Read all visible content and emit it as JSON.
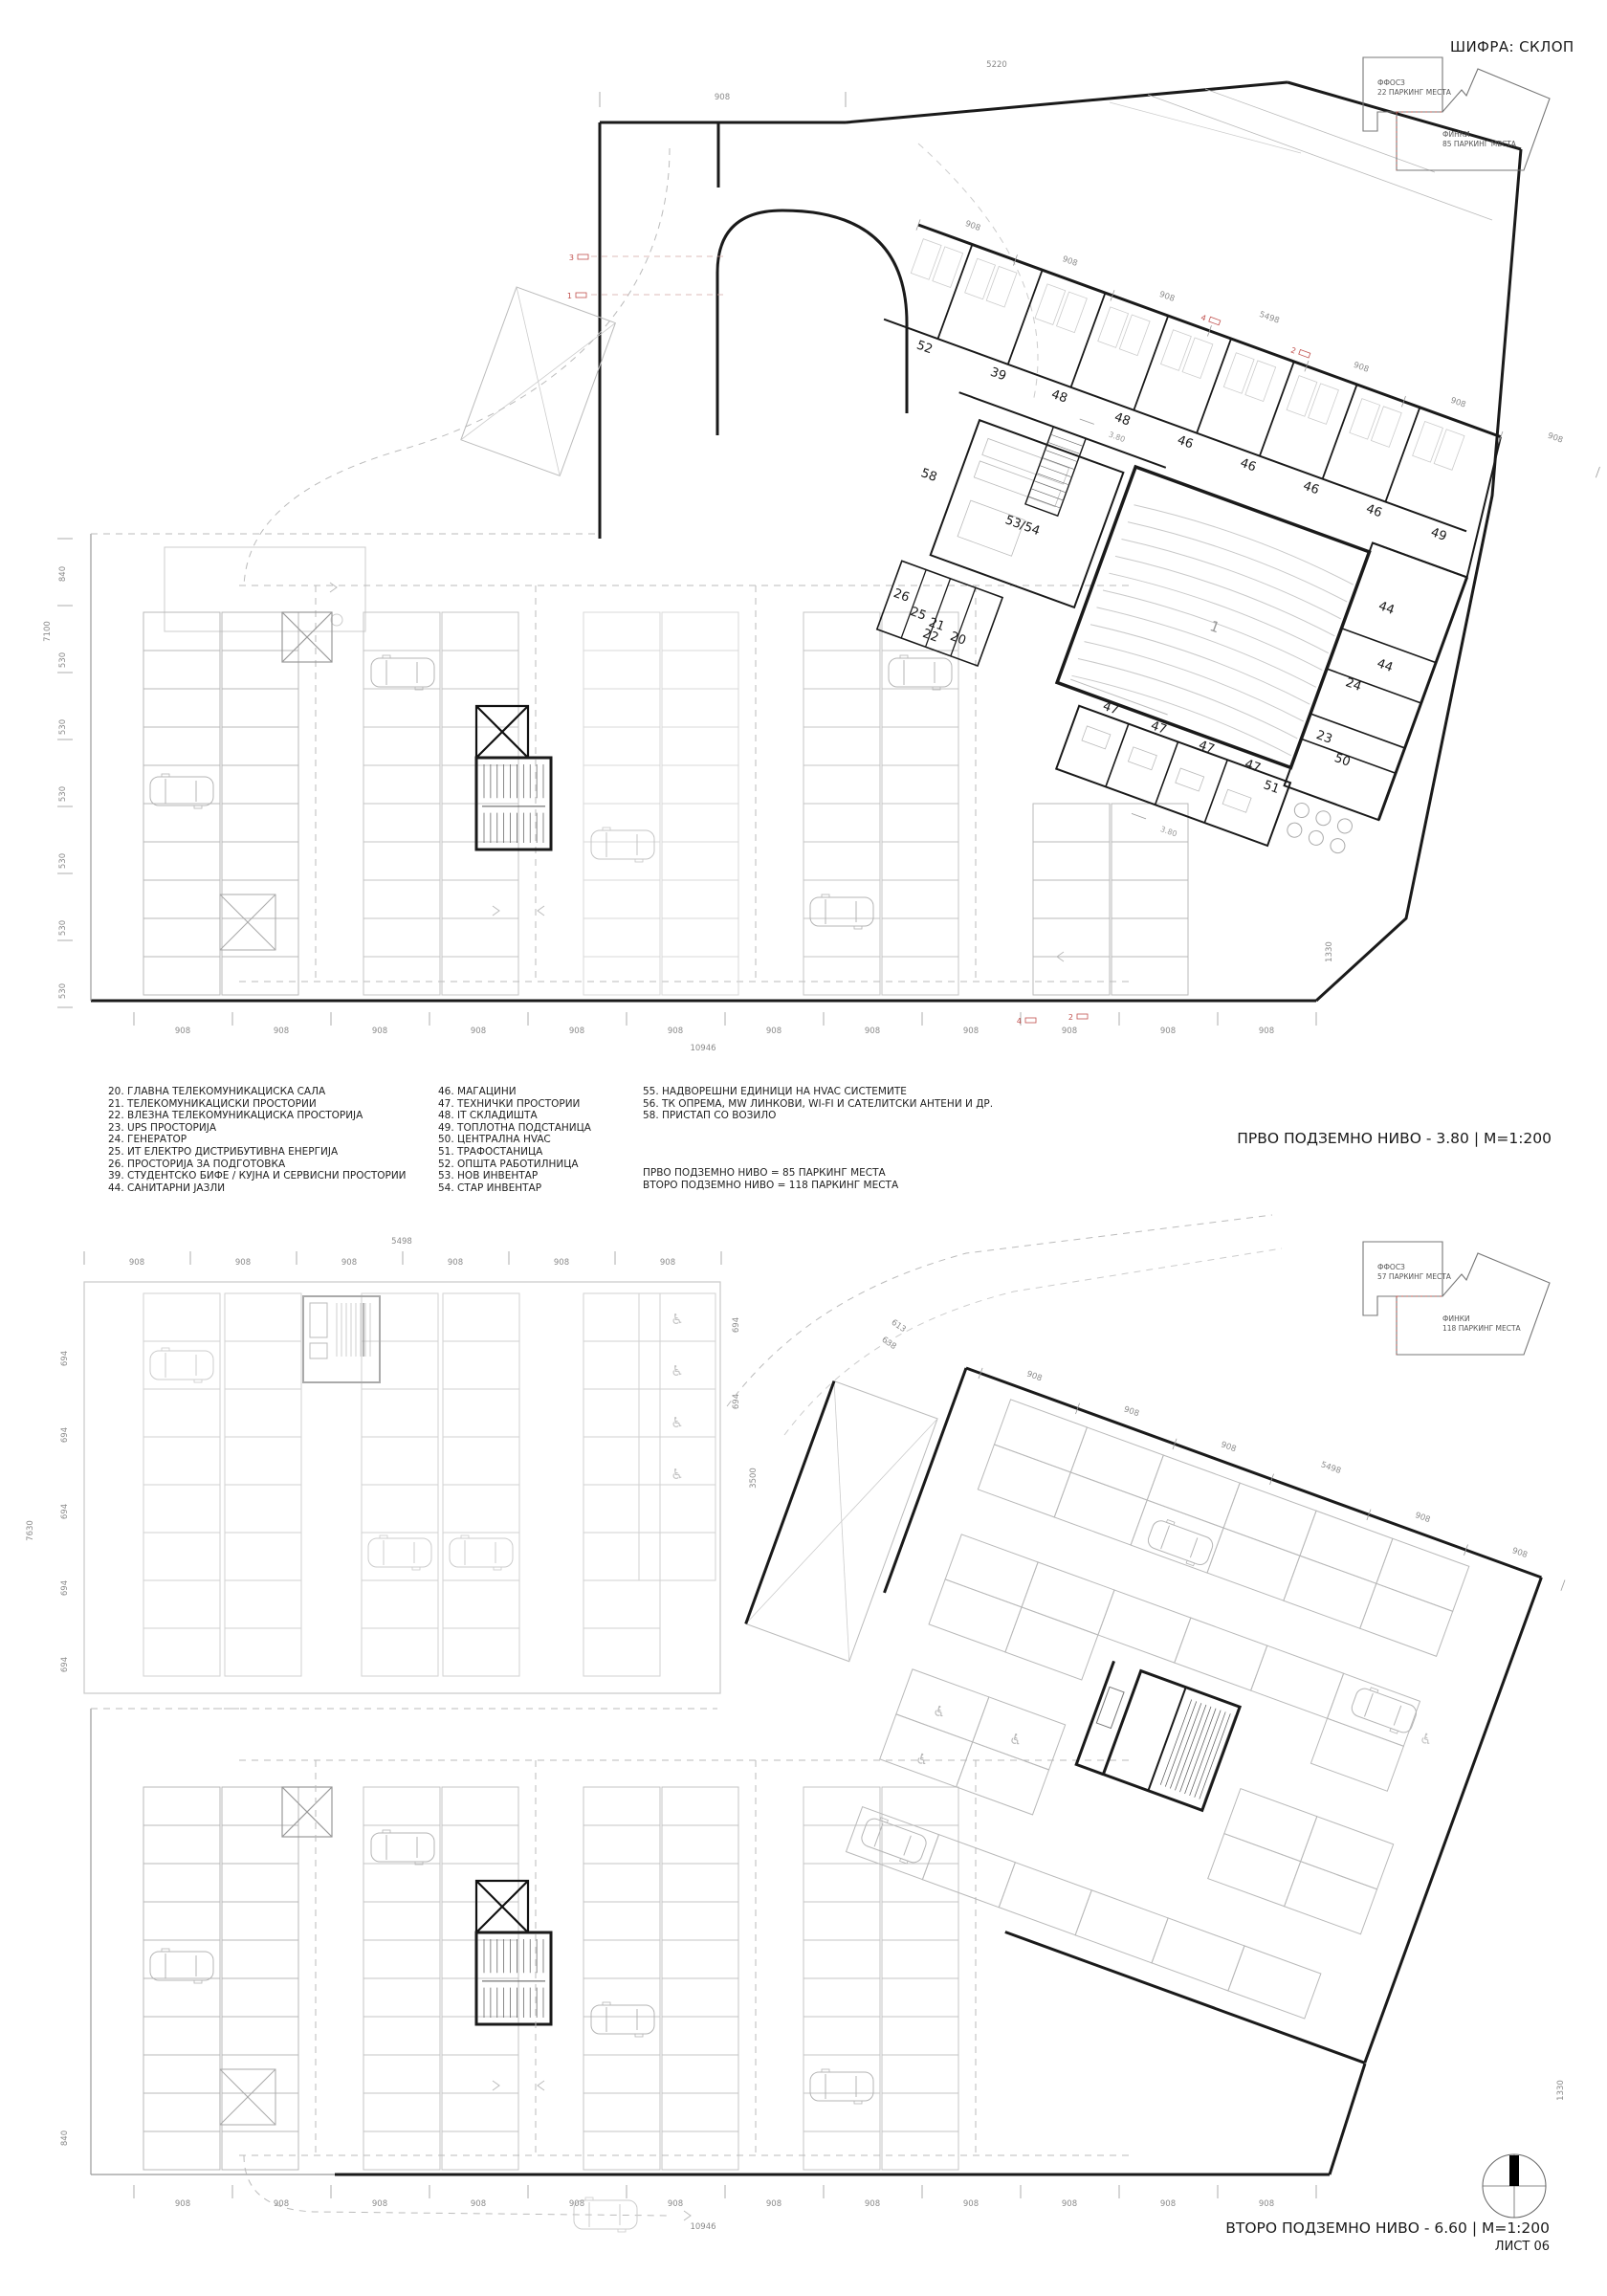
{
  "header": {
    "code": "ШИФРА: СКЛОП"
  },
  "keyplans": {
    "level1": {
      "zone_a_name": "ФФОСЗ",
      "zone_a_count": "22 ПАРКИНГ МЕСТА",
      "zone_b_name": "ФИНКИ",
      "zone_b_count": "85 ПАРКИНГ МЕСТА"
    },
    "level2": {
      "zone_a_name": "ФФОСЗ",
      "zone_a_count": "57 ПАРКИНГ МЕСТА",
      "zone_b_name": "ФИНКИ",
      "zone_b_count": "118 ПАРКИНГ МЕСТА"
    }
  },
  "legend": {
    "col1": [
      "20. ГЛАВНА ТЕЛЕКОМУНИКАЦИСКА САЛА",
      "21. ТЕЛЕКОМУНИКАЦИСКИ ПРОСТОРИИ",
      "22. ВЛЕЗНА ТЕЛЕКОМУНИКАЦИСКА ПРОСТОРИЈА",
      "23. UPS ПРОСТОРИЈА",
      "24. ГЕНЕРАТОР",
      "25. ИТ ЕЛЕКТРО ДИСТРИБУТИВНА ЕНЕРГИЈА",
      "26. ПРОСТОРИЈА ЗА ПОДГОТОВКА",
      "39. СТУДЕНТСКО БИФЕ / КУЈНА И СЕРВИСНИ ПРОСТОРИИ",
      "44. САНИТАРНИ ЈАЗЛИ"
    ],
    "col2": [
      "46. МАГАЦИНИ",
      "47. ТЕХНИЧКИ ПРОСТОРИИ",
      "48. IT СКЛАДИШТА",
      "49. ТОПЛОТНА ПОДСТАНИЦА",
      "50. ЦЕНТРАЛНА HVAC",
      "51. ТРАФОСТАНИЦА",
      "52. ОПШТА РАБОТИЛНИЦА",
      "53. НОВ ИНВЕНТАР",
      "54. СТАР ИНВЕНТАР"
    ],
    "col3": [
      "55. НАДВОРЕШНИ ЕДИНИЦИ НА HVAC СИСТЕМИТЕ",
      "56. ТК ОПРЕМА, MW ЛИНКОВИ, WI-FI И САТЕЛИТСКИ АНТЕНИ И ДР.",
      "58. ПРИСТАП СО ВОЗИЛО"
    ]
  },
  "notes": [
    "ПРВО ПОДЗЕМНО НИВО = 85 ПАРКИНГ МЕСТА",
    "ВТОРО ПОДЗЕМНО НИВО = 118 ПАРКИНГ МЕСТА"
  ],
  "plan1": {
    "title": "ПРВО ПОДЗЕМНО НИВО - 3.80 | М=1:200",
    "hall_label": "1",
    "room_labels": [
      "52",
      "39",
      "48",
      "48",
      "46",
      "46",
      "46",
      "46",
      "49",
      "58",
      "53/54",
      "26",
      "25",
      "21",
      "22",
      "20",
      "1",
      "44",
      "44",
      "24",
      "23",
      "50",
      "47",
      "47",
      "47",
      "47",
      "51"
    ],
    "level_marks": [
      "3.80",
      "3.80"
    ],
    "dims_top": [
      "908",
      "5220"
    ],
    "dims_wing": [
      "908",
      "908",
      "908",
      "5498",
      "908",
      "908",
      "908"
    ],
    "dims_bottom": [
      "908",
      "908",
      "908",
      "908",
      "908",
      "908",
      "908",
      "908",
      "908",
      "908",
      "908",
      "908"
    ],
    "dim_total_bottom": "10946",
    "dims_left": [
      "7100",
      "840",
      "530",
      "530",
      "530",
      "530",
      "530",
      "530"
    ],
    "dims_right": [
      "1330"
    ],
    "red_marks": [
      "3",
      "1",
      "4",
      "2",
      "4",
      "2"
    ]
  },
  "plan2": {
    "title": "ВТОРО ПОДЗЕМНО НИВО - 6.60 | М=1:200",
    "dims_top": [
      "5498",
      "908",
      "908",
      "908",
      "908",
      "908",
      "908"
    ],
    "dims_wing": [
      "908",
      "908",
      "908",
      "5498",
      "908",
      "908",
      "908",
      "908"
    ],
    "road_dims": [
      "613",
      "638"
    ],
    "dims_bottom": [
      "908",
      "908",
      "908",
      "908",
      "908",
      "908",
      "908",
      "908",
      "908",
      "908",
      "908",
      "908"
    ],
    "dim_total_bottom": "10946",
    "dims_left": [
      "7630",
      "694",
      "694",
      "694",
      "694",
      "694",
      "840"
    ],
    "dims_right": [
      "694",
      "694",
      "3500",
      "1330"
    ]
  },
  "sheet": {
    "number": "ЛИСТ 06"
  }
}
